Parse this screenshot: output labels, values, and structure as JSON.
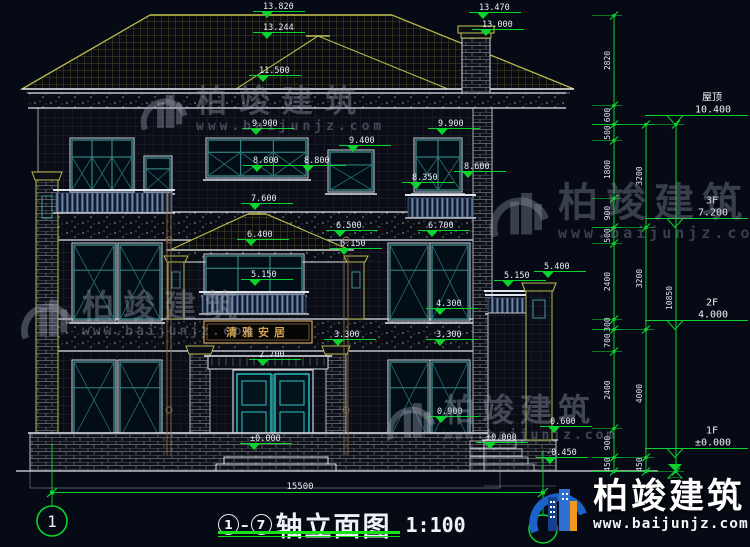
{
  "drawing": {
    "plaque_text": "清雅安居",
    "ground_dimension": "15500",
    "axis_left": "1",
    "title": {
      "axis_start": "1",
      "axis_end": "7",
      "name": "轴立面图",
      "scale": "1:100"
    },
    "watermark": {
      "brand": "柏竣建筑",
      "url": "www.baijunjz.com"
    },
    "colors": {
      "background": "#060a14",
      "dim_green": "#0bd42c",
      "line_white": "#dfe4ec",
      "roof_khaki": "#b9b94e",
      "window_teal": "#3e9898",
      "door_cyan": "#2fd8d8",
      "plaque_gold": "#d2a24c"
    },
    "levels": [
      {
        "t": "13.820",
        "x": 263,
        "y": 2
      },
      {
        "t": "13.244",
        "x": 263,
        "y": 23
      },
      {
        "t": "13.470",
        "x": 479,
        "y": 3
      },
      {
        "t": "13.000",
        "x": 482,
        "y": 20
      },
      {
        "t": "11.500",
        "x": 259,
        "y": 66
      },
      {
        "t": "9.900",
        "x": 252,
        "y": 119
      },
      {
        "t": "9.900",
        "x": 438,
        "y": 119
      },
      {
        "t": "9.400",
        "x": 349,
        "y": 136
      },
      {
        "t": "8.800",
        "x": 253,
        "y": 156
      },
      {
        "t": "8.800",
        "x": 304,
        "y": 156
      },
      {
        "t": "8.600",
        "x": 464,
        "y": 162
      },
      {
        "t": "8.350",
        "x": 412,
        "y": 173
      },
      {
        "t": "7.600",
        "x": 251,
        "y": 194
      },
      {
        "t": "6.700",
        "x": 428,
        "y": 221
      },
      {
        "t": "6.500",
        "x": 336,
        "y": 221
      },
      {
        "t": "6.400",
        "x": 247,
        "y": 230
      },
      {
        "t": "6.150",
        "x": 340,
        "y": 239
      },
      {
        "t": "5.400",
        "x": 544,
        "y": 262
      },
      {
        "t": "5.150",
        "x": 504,
        "y": 271
      },
      {
        "t": "5.150",
        "x": 251,
        "y": 270
      },
      {
        "t": "4.300",
        "x": 436,
        "y": 299
      },
      {
        "t": "3.300",
        "x": 334,
        "y": 330
      },
      {
        "t": "3.300",
        "x": 436,
        "y": 330
      },
      {
        "t": "2.700",
        "x": 259,
        "y": 350
      },
      {
        "t": "0.900",
        "x": 437,
        "y": 407
      },
      {
        "t": "0.600",
        "x": 550,
        "y": 417
      },
      {
        "t": "±0.000",
        "x": 250,
        "y": 434
      },
      {
        "t": "±0.000",
        "x": 486,
        "y": 433
      },
      {
        "t": "-0.450",
        "x": 546,
        "y": 448
      }
    ],
    "floor_markers": [
      {
        "label": "屋顶",
        "value": "10.400",
        "level": 10.4
      },
      {
        "label": "3F",
        "value": "7.200",
        "level": 7.2
      },
      {
        "label": "2F",
        "value": "4.000",
        "level": 4.0
      },
      {
        "label": "1F",
        "value": "±0.000",
        "level": 0.0
      }
    ],
    "dim_chains": [
      {
        "x": 614,
        "levels": [
          13.82,
          11.0,
          10.4,
          9.9,
          8.1,
          7.2,
          6.7,
          4.3,
          4.0,
          3.3,
          0.9,
          0.0,
          -0.45
        ],
        "segments": [
          "2820",
          "600",
          "500",
          "1800",
          "900",
          "500",
          "2400",
          "300",
          "700",
          "2400",
          "900",
          "450"
        ]
      },
      {
        "x": 646,
        "levels": [
          10.4,
          7.2,
          4.0,
          0.0,
          -0.45
        ],
        "segments": [
          "3200",
          "3200",
          "4000",
          "450"
        ]
      },
      {
        "x": 676,
        "levels": [
          10.4,
          -0.45
        ],
        "segments": [
          "10850"
        ]
      }
    ]
  }
}
